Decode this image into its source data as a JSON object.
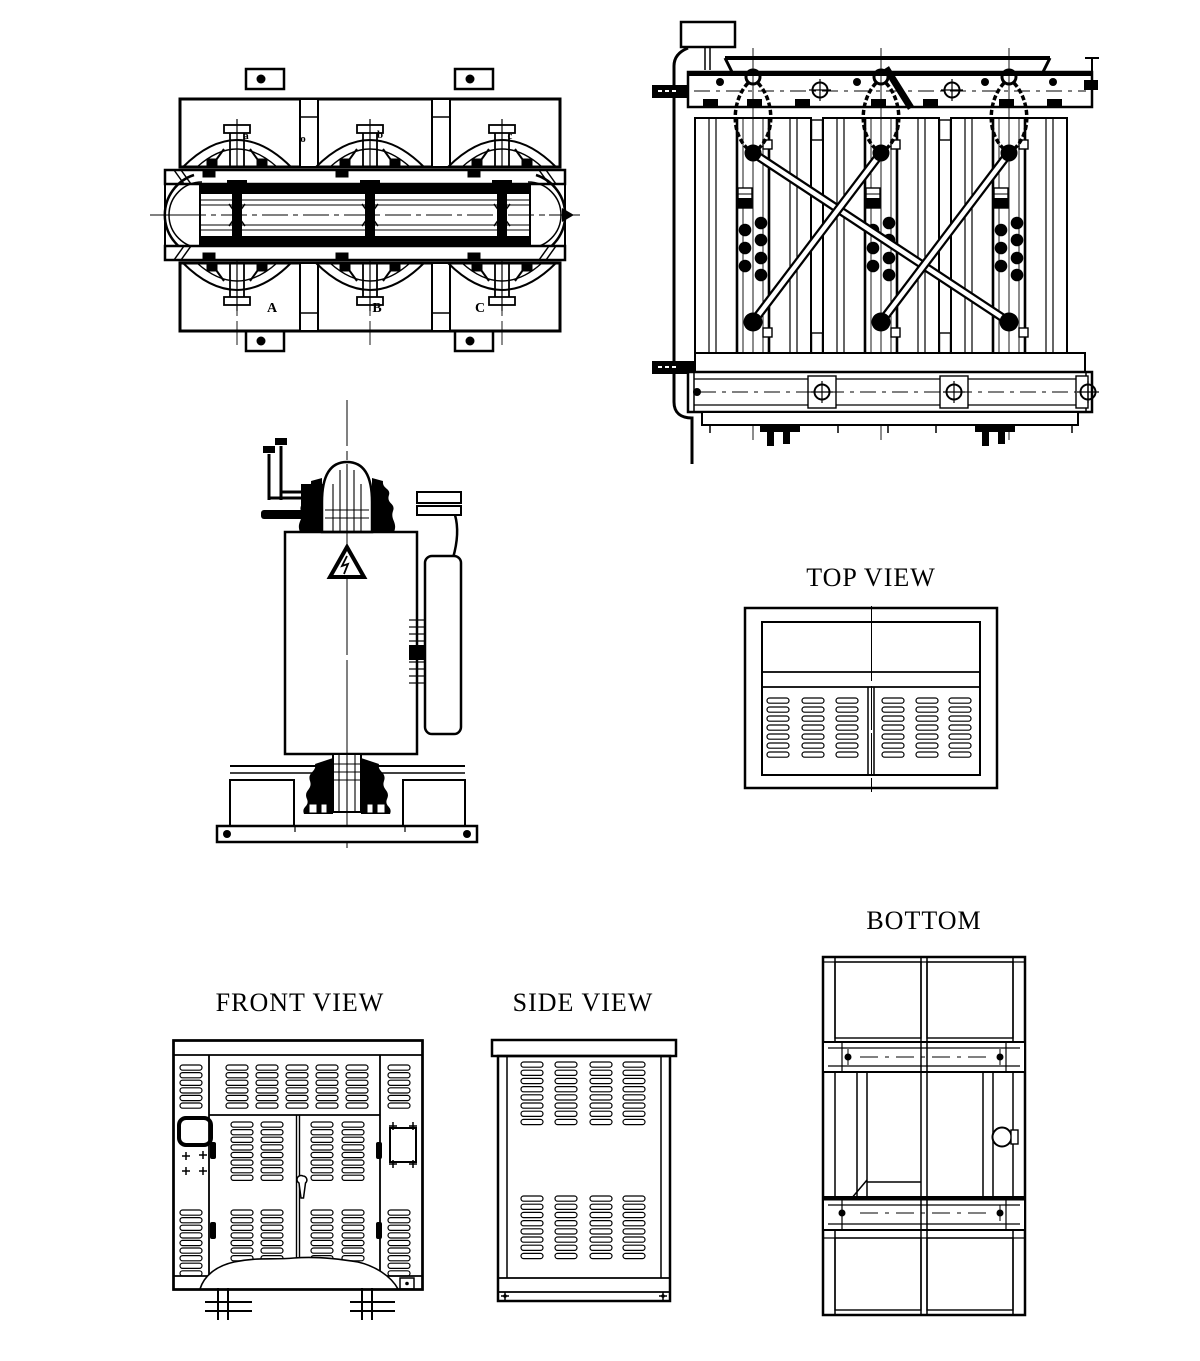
{
  "colors": {
    "ink": "#000000",
    "paper": "#ffffff"
  },
  "titles": {
    "top_view": "TOP VIEW",
    "front_view": "FRONT VIEW",
    "side_view": "SIDE VIEW",
    "bottom": "BOTTOM"
  },
  "terminals": {
    "lv_a": "a",
    "lv_o": "o",
    "lv_b": "b",
    "lv_c": "c",
    "hv_a": "A",
    "hv_b": "B",
    "hv_c": "C"
  }
}
